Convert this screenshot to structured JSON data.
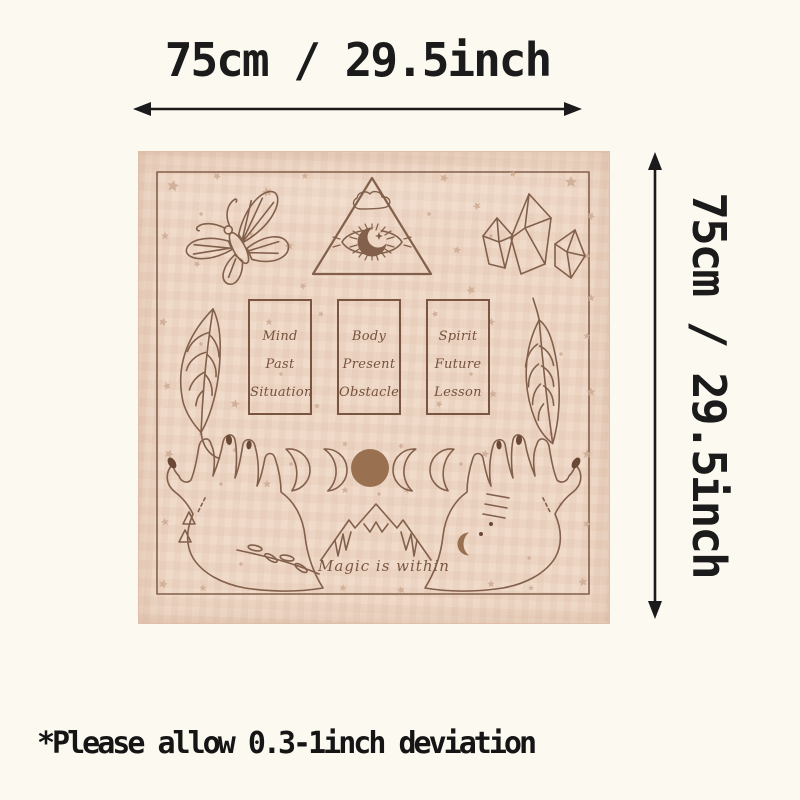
{
  "dimensions": {
    "width_label": "75cm / 29.5inch",
    "height_label": "75cm / 29.5inch"
  },
  "footnote": "*Please allow 0.3-1inch deviation",
  "cloth": {
    "caption": "Magic is within",
    "cards": [
      {
        "lines": [
          "Mind",
          "Past",
          "Situation"
        ]
      },
      {
        "lines": [
          "Body",
          "Present",
          "Obstacle"
        ]
      },
      {
        "lines": [
          "Spirit",
          "Future",
          "Lesson"
        ]
      }
    ],
    "motifs": [
      "butterfly-icon",
      "eye-triangle-icon",
      "cloud-icon",
      "crystals-icon",
      "feather-left-icon",
      "feather-right-icon",
      "card-outlines",
      "moon-phases-icon",
      "full-moon",
      "mountains-icon",
      "left-hand-icon",
      "right-hand-icon",
      "stars-pattern"
    ],
    "colors": {
      "fabric": "#eed6c4",
      "line_art": "#82604b",
      "stars": "#cfae97",
      "full_moon": "#997050",
      "card_text": "#76523e"
    }
  },
  "annotation": {
    "ink_color": "#1b1b1b"
  }
}
